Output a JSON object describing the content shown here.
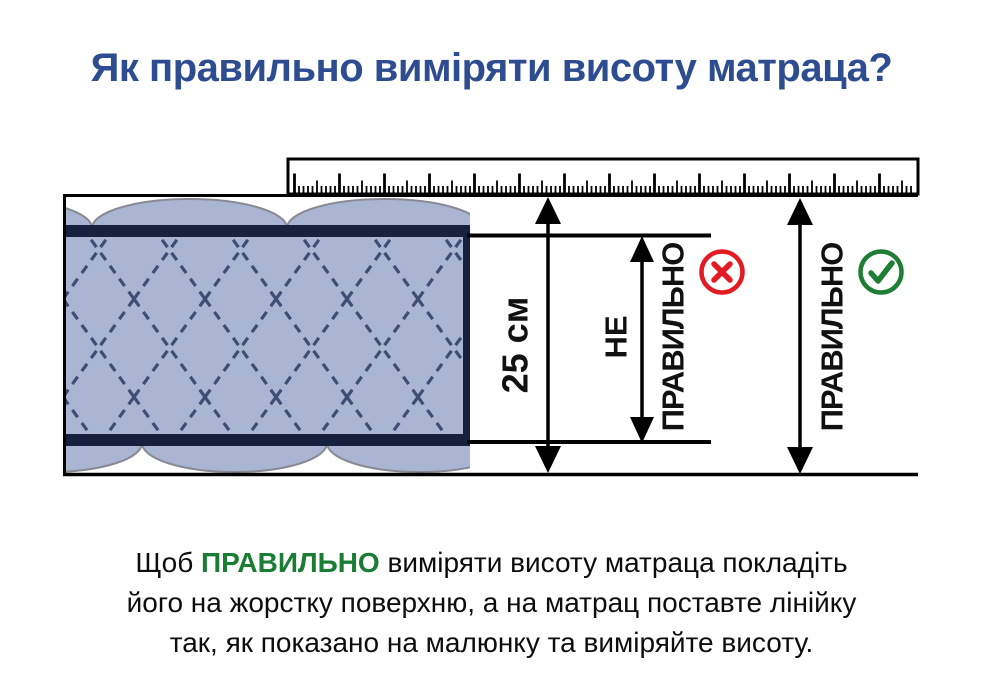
{
  "title": {
    "text": "Як правильно виміряти висоту матраца?",
    "color": "#2e4d91"
  },
  "diagram": {
    "labels": {
      "height_value": "25 см",
      "wrong_line1": "НЕ",
      "wrong_line2": "ПРАВИЛЬНО",
      "correct": "ПРАВИЛЬНО"
    },
    "icons": {
      "wrong": "x-circle",
      "correct": "check-circle"
    },
    "colors": {
      "mattress_fill": "#a9b5d3",
      "quilt_stitch": "#3d4e74",
      "edge_band": "#15213f",
      "scallop_outline": "#8a8a94",
      "line_black": "#000000",
      "wrong_red": "#e41b23",
      "correct_green": "#1e7e34"
    }
  },
  "caption": {
    "line1_prefix": "Щоб ",
    "highlight": "ПРАВИЛЬНО",
    "line1_suffix": " виміряти висоту матраца покладіть",
    "line2": "його на жорстку поверхню, а на матрац поставте лінійку",
    "line3": "так, як показано на малюнку та виміряйте висоту.",
    "highlight_color": "#1a7d33"
  }
}
